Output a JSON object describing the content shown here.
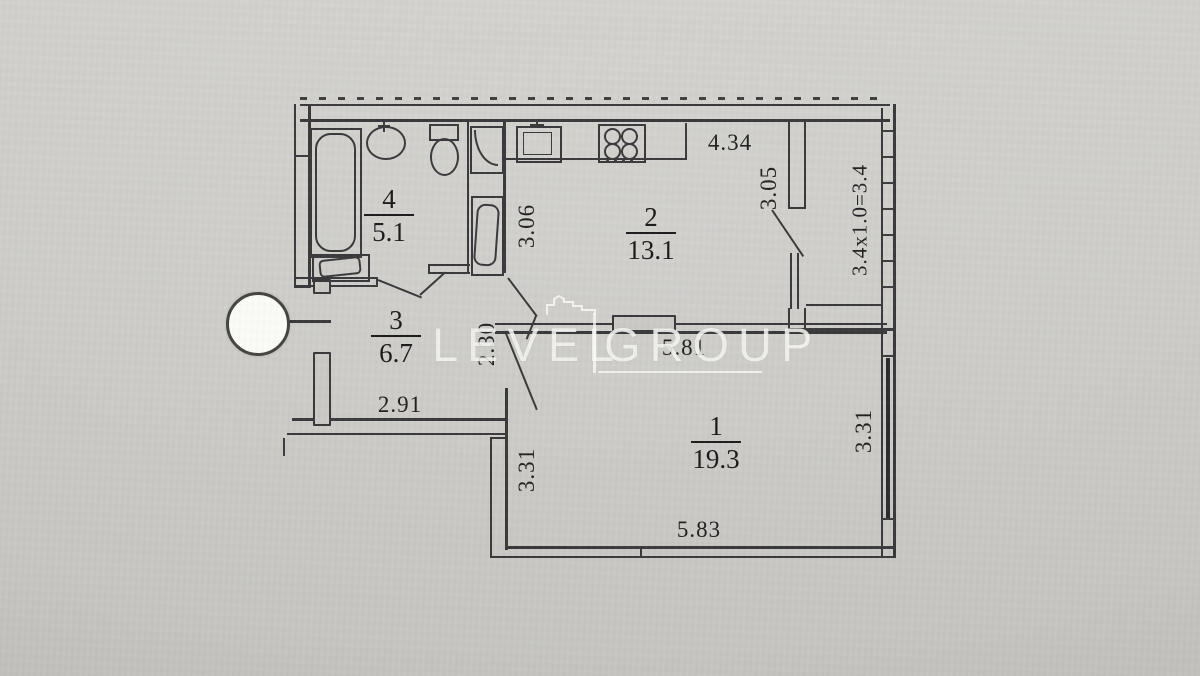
{
  "watermark": {
    "left": "LEVEL",
    "right": "GROUP"
  },
  "rooms": {
    "bathroom": {
      "number": "4",
      "area": "5.1"
    },
    "kitchen": {
      "number": "2",
      "area": "13.1"
    },
    "hall": {
      "number": "3",
      "area": "6.7"
    },
    "living": {
      "number": "1",
      "area": "19.3"
    }
  },
  "dimensions": {
    "kitchen_top": "4.34",
    "kitchen_right": "3.05",
    "kitchen_left": "3.06",
    "balcony": "3.4x1.0=3.4",
    "hall_passage": "2.30",
    "living_top": "5.81",
    "hall_bottom": "2.91",
    "living_left": "3.31",
    "living_right": "3.31",
    "living_bottom": "5.83"
  },
  "colors": {
    "ink": "#3a3a3c",
    "paper": "#cbcac6",
    "watermark": "#fbfbf9"
  }
}
